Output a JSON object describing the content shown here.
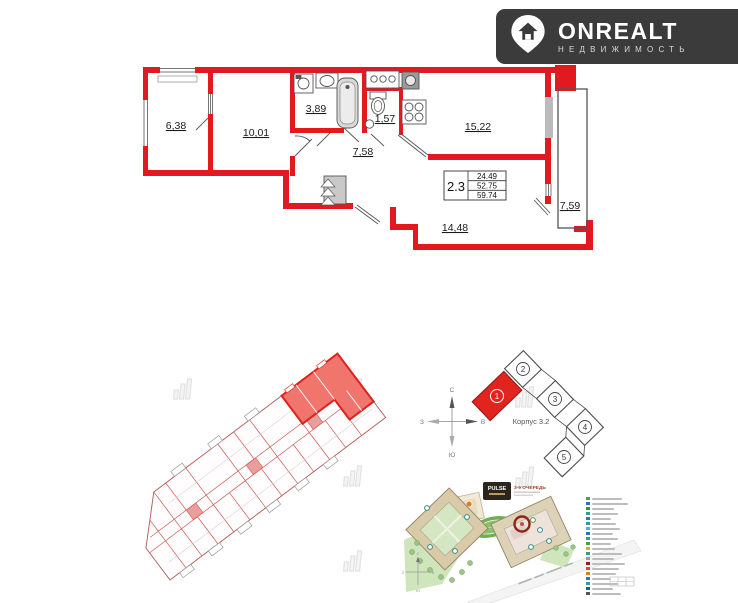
{
  "logo": {
    "title": "ONREALT",
    "subtitle": "НЕДВИЖИМОСТЬ"
  },
  "floorplan": {
    "wall_color": "#e2191e",
    "rooms": [
      {
        "name": "loggia-left",
        "area": "6,38"
      },
      {
        "name": "bedroom-2",
        "area": "10,01"
      },
      {
        "name": "bathroom",
        "area": "3,89"
      },
      {
        "name": "wc",
        "area": "1,57"
      },
      {
        "name": "kitchen-living",
        "area": "15,22"
      },
      {
        "name": "hallway",
        "area": "7,58"
      },
      {
        "name": "bedroom-1",
        "area": "14,48"
      },
      {
        "name": "loggia-right",
        "area": "7,59"
      }
    ],
    "table": {
      "type": "2.3",
      "living_area": "24.49",
      "area": "52.75",
      "total_area": "59.74"
    }
  },
  "keyplan": {
    "corpus_label": "Корпус 3.2",
    "compass": {
      "n": "С",
      "s": "Ю",
      "w": "З",
      "e": "В"
    },
    "highlight_color": "#e2241f",
    "sections": [
      {
        "number": "1",
        "highlighted": true
      },
      {
        "number": "2",
        "highlighted": false
      },
      {
        "number": "3",
        "highlighted": false
      },
      {
        "number": "4",
        "highlighted": false
      },
      {
        "number": "5",
        "highlighted": false
      }
    ]
  },
  "siteplan": {
    "developer": "PULSE",
    "phase_label": "3-9 ОЧЕРЕДЬ",
    "highlight_ring_color": "#8e2418",
    "legend_colors": [
      "#4f9d45",
      "#2f74b5",
      "#3f8f3f",
      "#2fa08e",
      "#2f74b5",
      "#2fa08e",
      "#45b8c8",
      "#2f74b5",
      "#2fa08e",
      "#4f9d45",
      "#e0a32e",
      "#2fa08e",
      "#9a9a9a",
      "#8e2418",
      "#d04a3a",
      "#e07b28",
      "#2f74b5",
      "#2fa08e",
      "#2f5496",
      "#555555"
    ]
  }
}
